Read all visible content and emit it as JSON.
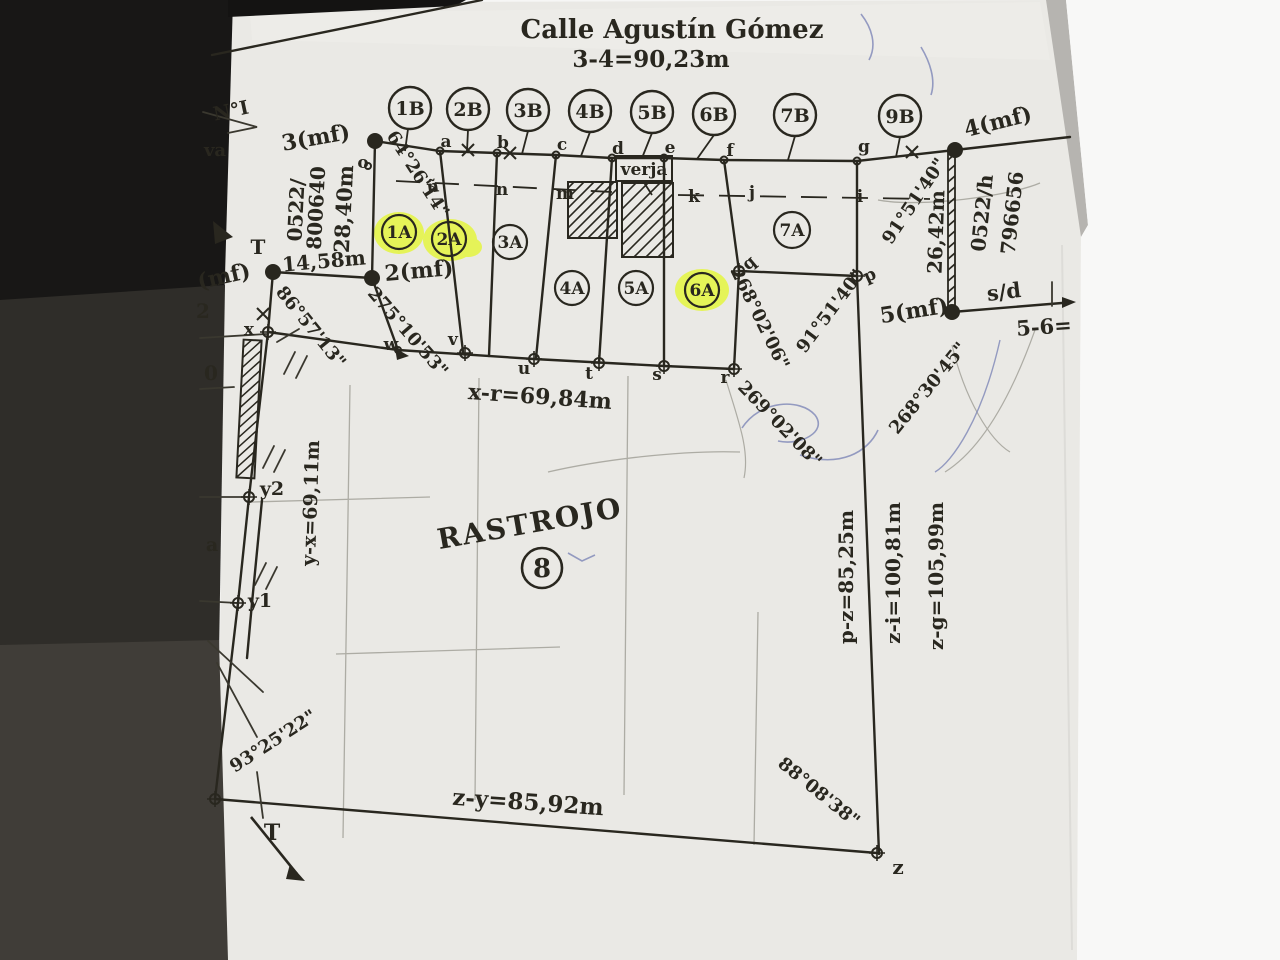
{
  "street": {
    "name": "Calle Agustín Gómez",
    "dimension": "3-4=90,23m"
  },
  "lots_b": {
    "b1": "1B",
    "b2": "2B",
    "b3": "3B",
    "b4": "4B",
    "b5": "5B",
    "b6": "6B",
    "b7": "7B",
    "b9": "9B"
  },
  "lots_a": {
    "a1": "1A",
    "a2": "2A",
    "a3": "3A",
    "a4": "4A",
    "a5": "5A",
    "a6": "6A",
    "a7": "7A"
  },
  "parcel": {
    "label": "RASTROJO",
    "number": "8"
  },
  "corners": {
    "mf1": "(mf)",
    "mf2": "2(mf)",
    "mf3": "3(mf)",
    "mf4": "4(mf)",
    "mf5": "5(mf)",
    "sd": "s/d"
  },
  "points": {
    "o": "o",
    "a": "a",
    "b": "b",
    "c": "c",
    "d": "d",
    "e": "e",
    "f": "f",
    "g": "g",
    "nn": "ñ",
    "n": "n",
    "m": "m",
    "k": "k",
    "j": "j",
    "i": "i",
    "w": "w",
    "v": "v",
    "u": "u",
    "t": "t",
    "s": "s",
    "r": "r",
    "q": "q",
    "p": "p",
    "x": "x",
    "y1": "y1",
    "y2": "y2",
    "z": "z"
  },
  "measures": {
    "m3_2": "28,40m",
    "m1_2": "14,58m",
    "m4_5": "26,42m",
    "xr": "x-r=69,84m",
    "yx": "y-x=69,11m",
    "pz": "p-z=85,25m",
    "zi": "z-i=100,81m",
    "zg": "z-g=105,99m",
    "zy": "z-y=85,92m",
    "s56": "5-6="
  },
  "angles": {
    "a64": "64°26'14\"",
    "a86": "86°57'13\"",
    "a275": "275°10'53\"",
    "a268a": "268°02'06\"",
    "a91a": "91°51'40\"",
    "a91b": "91°51'40\"",
    "a269": "269°02'08\"",
    "a268b": "268°30'45\"",
    "a93": "93°25'22\"",
    "a88": "88°08'38\""
  },
  "registry": {
    "code_left": "0522/",
    "num_left": "800640",
    "code_right": "0522/h",
    "num_right": "796656"
  },
  "misc": {
    "sheet": "N°I",
    "va": "va",
    "verja": "verja",
    "t_upper": "T",
    "t_lower": "T",
    "digit2": "2",
    "digit0": "0",
    "letter_a": "a"
  },
  "colors": {
    "ink": "#29271f",
    "paper": "#eae9e5",
    "highlight": "#e4f635",
    "photo_dark": "#1c1b19",
    "edge_gray": "#b6b4b0",
    "pen_blue": "#7d86b6",
    "pencil": "#a2a199"
  }
}
